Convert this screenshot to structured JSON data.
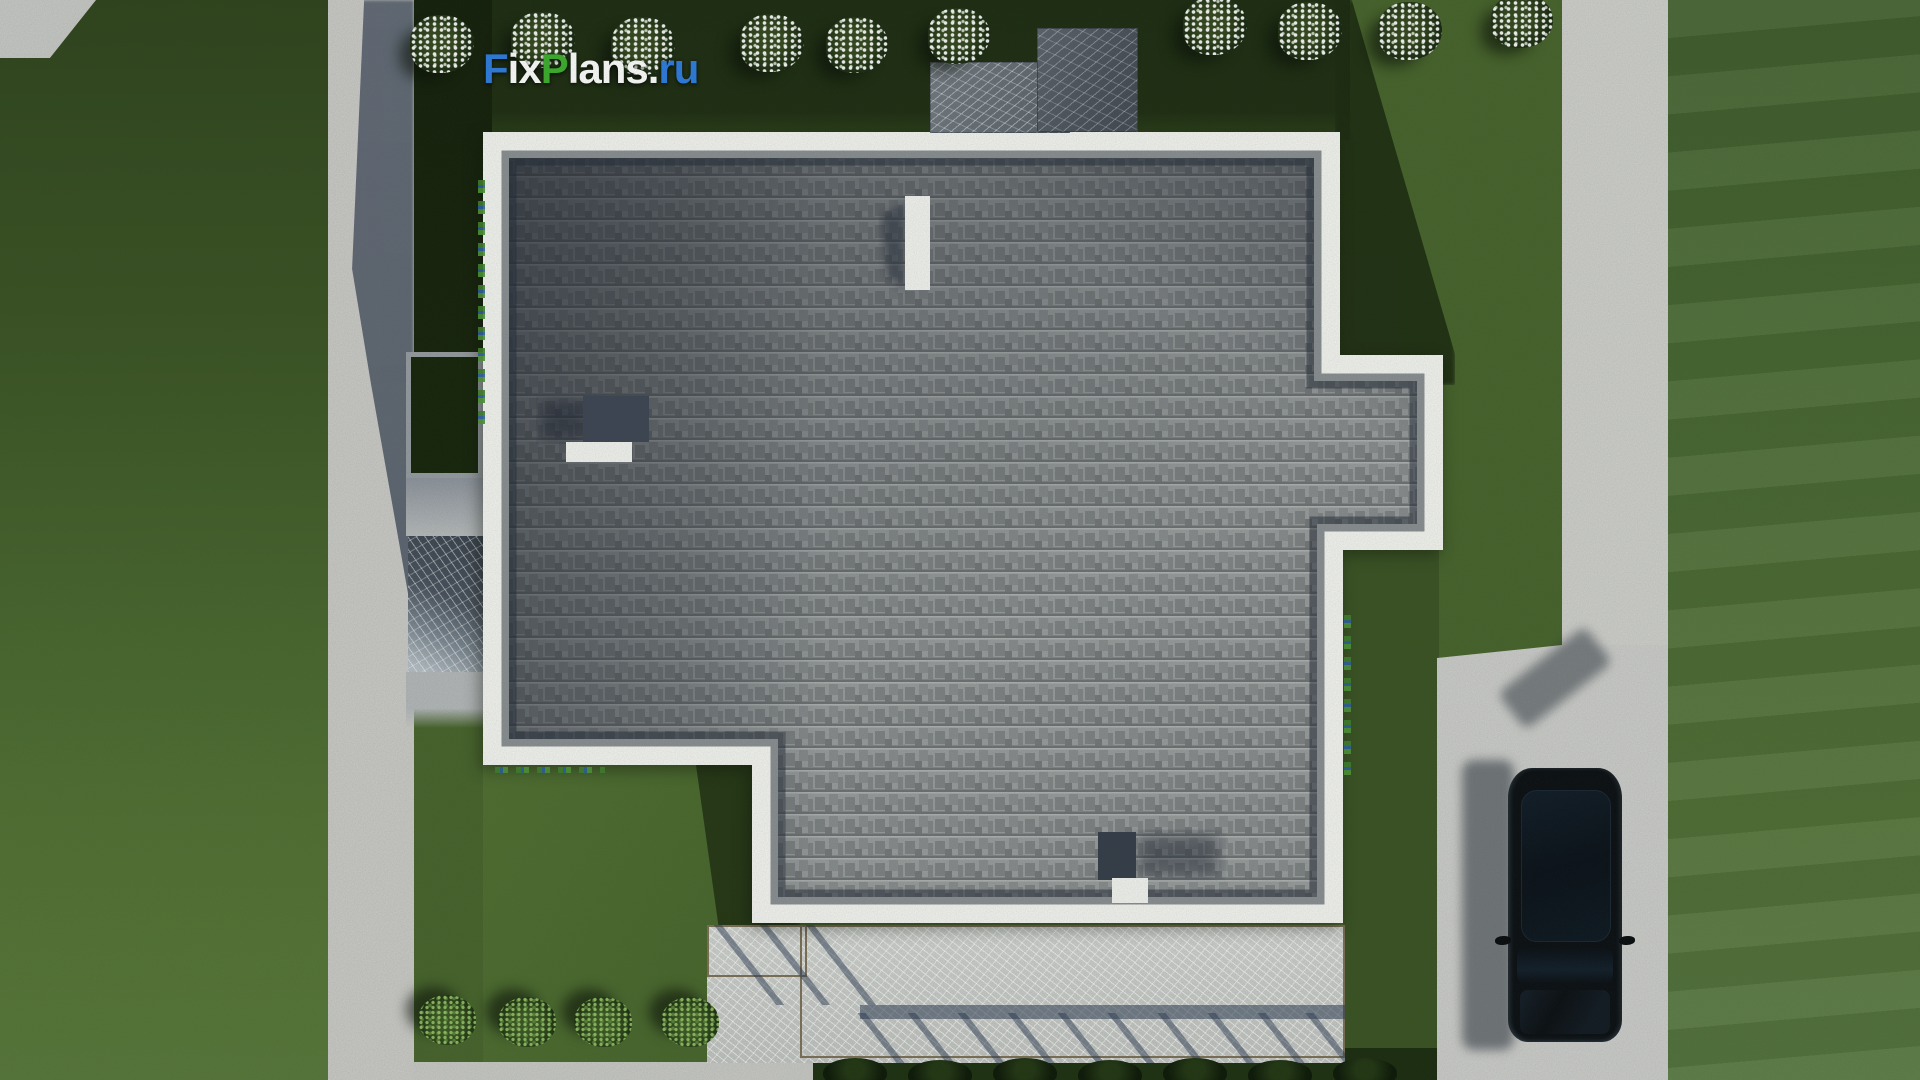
{
  "brand": {
    "full": "FixPlans.ru",
    "segments": [
      {
        "text": "F",
        "color": "#2e7ce0"
      },
      {
        "text": "ix",
        "color": "#ffffff"
      },
      {
        "text": "P",
        "color": "#3dae2d"
      },
      {
        "text": "lans",
        "color": "#ffffff"
      },
      {
        "text": ".",
        "color": "#ffffff"
      },
      {
        "text": "ru",
        "color": "#2e7ce0"
      }
    ]
  },
  "palette": {
    "grass": "#47632c",
    "grass_shadow": "#1c2a11",
    "path_concrete": "#cac9c7",
    "path_shadowed": "#5d6573",
    "roof_border": "#f4f4f1",
    "roof_shingles": "#95989a",
    "roof_edge_shadow": "#1f2735",
    "terrace_marble": "#c6c8c6",
    "terrace_frame": "#7d6f58",
    "chimney_slab": "#5d636d",
    "car_body": "#0b0e13",
    "shrub_bloom": "#ffffff",
    "bush_green": "#3c5724"
  },
  "scene": {
    "objects": [
      "flat-roof-house",
      "shingled-roof",
      "roof-parapet",
      "roof-vent",
      "roof-hatch",
      "chimney",
      "chimney-slabs",
      "entrance-porch",
      "terrace-patio",
      "pergola-shadow",
      "driveway",
      "parked-car",
      "garden-path",
      "flowering-shrubs",
      "green-bushes",
      "lawn"
    ]
  }
}
